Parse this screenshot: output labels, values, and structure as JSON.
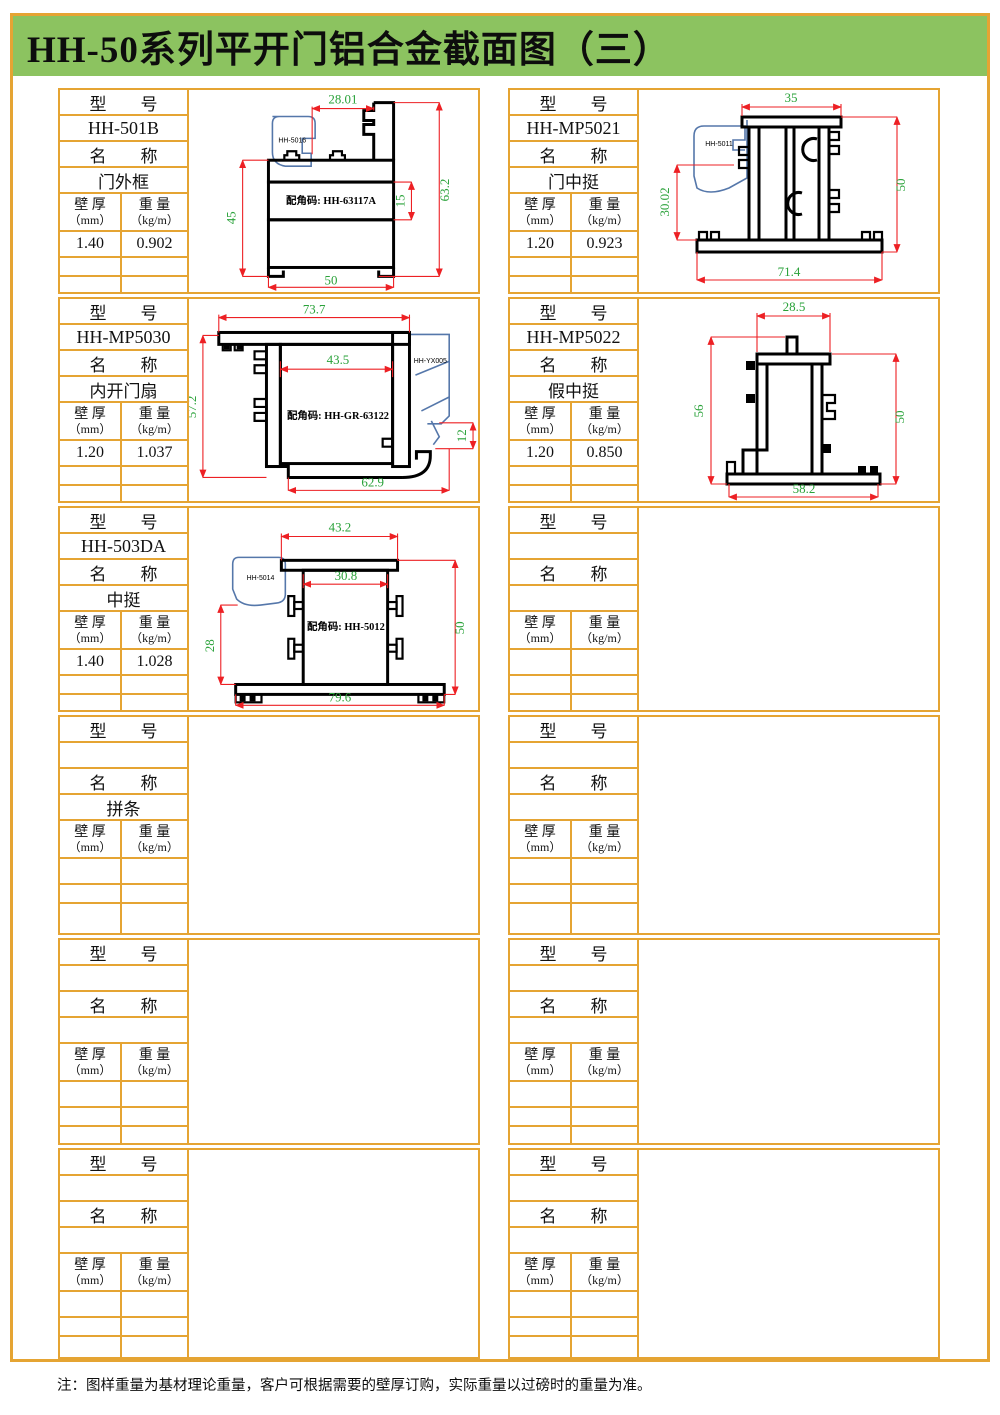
{
  "header": {
    "title": "HH-50系列平开门铝合金截面图（三）"
  },
  "table_labels": {
    "model": "型　　号",
    "name": "名　　称",
    "wall_l1": "壁 厚",
    "wall_l2": "（mm）",
    "weight_l1": "重 量",
    "weight_l2": "（kg/m）"
  },
  "footer_note": "注：图样重量为基材理论重量，客户可根据需要的壁厚订购，实际重量以过磅时的重量为准。",
  "panels": [
    {
      "model": "HH-501B",
      "name": "门外框",
      "wall": "1.40",
      "weight": "0.902",
      "drawing": {
        "part_label": "HH-5016",
        "corner_code": "配角码: HH-63117A",
        "dim_top": "28.01",
        "dim_right": "63.2",
        "dim_inner": "15",
        "dim_left": "45",
        "dim_bottom": "50"
      }
    },
    {
      "model": "HH-MP5021",
      "name": "门中挺",
      "wall": "1.20",
      "weight": "0.923",
      "drawing": {
        "part_label": "HH-5011",
        "dim_top": "35",
        "dim_right": "50",
        "dim_left": "30.02",
        "dim_bottom": "71.4"
      }
    },
    {
      "model": "HH-MP5030",
      "name": "内开门扇",
      "wall": "1.20",
      "weight": "1.037",
      "drawing": {
        "part_label": "HH-YX005",
        "corner_code": "配角码: HH-GR-63122",
        "dim_top": "73.7",
        "dim_inner": "43.5",
        "dim_left": "57.2",
        "dim_right": "12",
        "dim_bottom": "62.9"
      }
    },
    {
      "model": "HH-MP5022",
      "name": "假中挺",
      "wall": "1.20",
      "weight": "0.850",
      "drawing": {
        "dim_top": "28.5",
        "dim_left": "56",
        "dim_right": "50",
        "dim_bottom": "58.2"
      }
    },
    {
      "model": "HH-503DA",
      "name": "中挺",
      "wall": "1.40",
      "weight": "1.028",
      "drawing": {
        "part_label": "HH-5014",
        "corner_code": "配角码: HH-5012",
        "dim_top": "43.2",
        "dim_inner": "30.8",
        "dim_left": "28",
        "dim_right": "50",
        "dim_bottom": "79.6"
      }
    },
    {
      "model": "",
      "name": "",
      "wall": "",
      "weight": ""
    },
    {
      "model": "",
      "name": "拼条",
      "wall": "",
      "weight": ""
    },
    {
      "model": "",
      "name": "",
      "wall": "",
      "weight": ""
    },
    {
      "model": "",
      "name": "",
      "wall": "",
      "weight": ""
    },
    {
      "model": "",
      "name": "",
      "wall": "",
      "weight": ""
    },
    {
      "model": "",
      "name": "",
      "wall": "",
      "weight": ""
    },
    {
      "model": "",
      "name": "",
      "wall": "",
      "weight": ""
    }
  ]
}
